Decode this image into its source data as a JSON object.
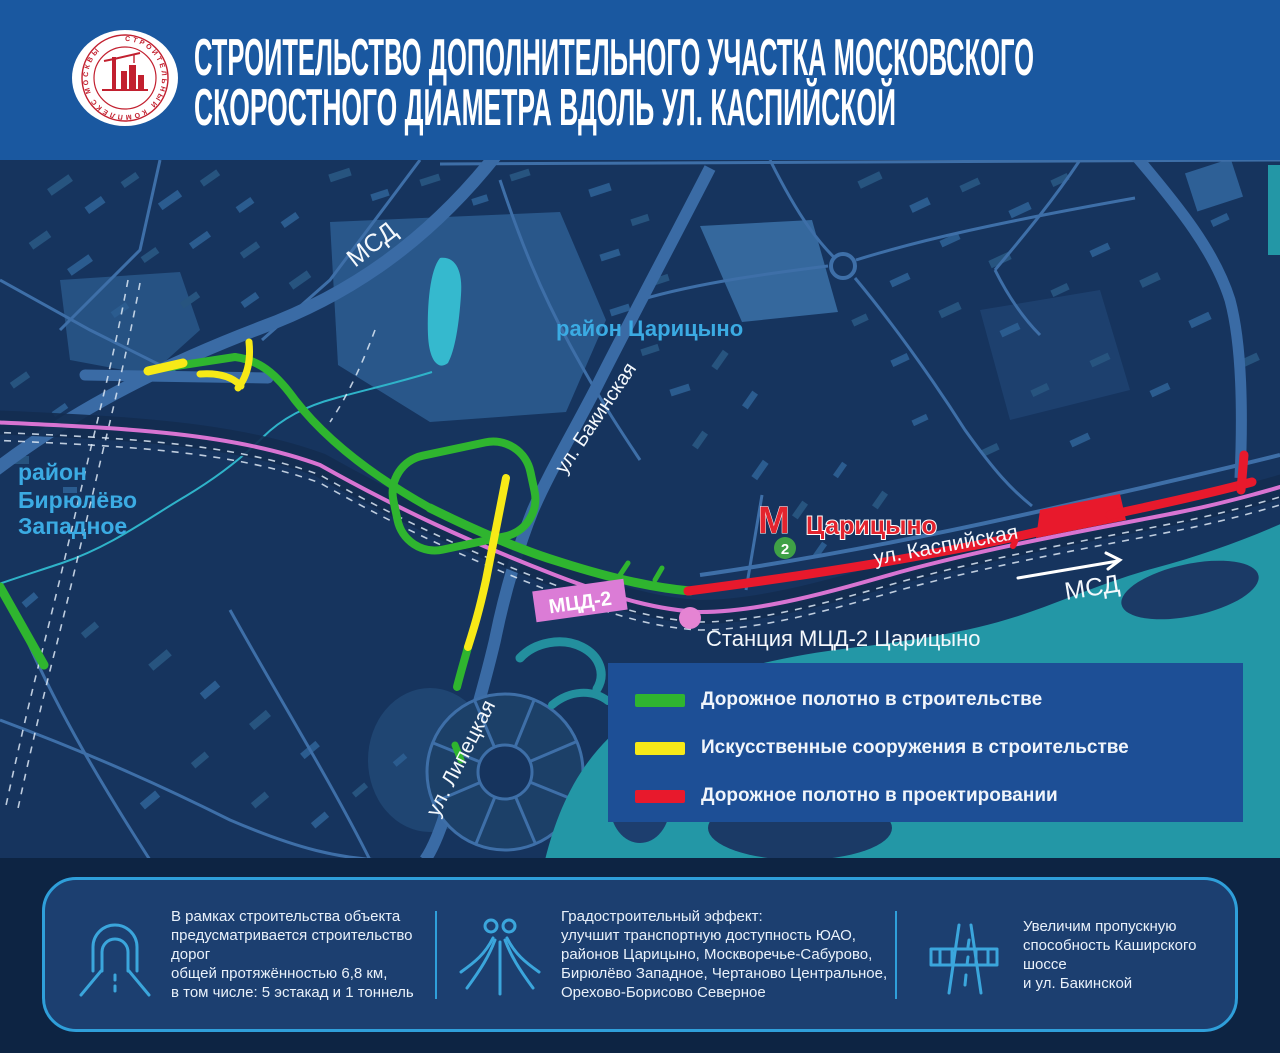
{
  "header": {
    "title_line1": "СТРОИТЕЛЬСТВО ДОПОЛНИТЕЛЬНОГО УЧАСТКА МОСКОВСКОГО",
    "title_line2": "СКОРОСТНОГО ДИАМЕТРА ВДОЛЬ УЛ. КАСПИЙСКОЙ",
    "logo_ring_text": "СТРОИТЕЛЬНЫЙ КОМПЛЕКС МОСКВЫ"
  },
  "map": {
    "labels": {
      "msd_top": "МСД",
      "district_tsaritsyno": "район Царицыно",
      "street_bakinskaya": "ул. Бакинская",
      "district_biryulyovo_line1": "район",
      "district_biryulyovo_line2": "Бирюлёво",
      "district_biryulyovo_line3": "Западное",
      "metro_m": "М",
      "metro_station": "Царицыно",
      "metro_line_number": "2",
      "street_kaspiyskaya": "ул. Каспийская",
      "msd_right": "МСД",
      "mcd2_badge": "МЦД-2",
      "mcd2_station": "Станция МЦД-2 Царицыно",
      "street_lipetskaya": "ул. Липецкая"
    },
    "colors": {
      "construction_green": "#2FB52F",
      "structures_yellow": "#F7E917",
      "design_red": "#E8192C",
      "mcd2_pink": "#DB7CD6",
      "metro_red": "#E3242E",
      "district_cyan": "#3BABE3"
    }
  },
  "legend": {
    "items": [
      {
        "color": "#2FB52F",
        "label": "Дорожное полотно в строительстве"
      },
      {
        "color": "#F7E917",
        "label": "Искусственные сооружения в строительстве"
      },
      {
        "color": "#E8192C",
        "label": "Дорожное полотно в проектировании"
      }
    ]
  },
  "footer": {
    "items": [
      {
        "icon": "tunnel-icon",
        "text": "В рамках строительства объекта\nпредусматривается строительство дорог\nобщей протяжённостью 6,8 км,\nв том числе: 5 эстакад и 1 тоннель"
      },
      {
        "icon": "interchange-icon",
        "text": "Градостроительный эффект:\nулучшит транспортную доступность ЮАО,\nрайонов Царицыно, Москворечье-Сабурово,\nБирюлёво Западное, Чертаново Центральное,\nОрехово-Борисово Северное"
      },
      {
        "icon": "highway-icon",
        "text": "Увеличим пропускную\nспособность Каширского шоссе\nи ул. Бакинской"
      }
    ]
  }
}
